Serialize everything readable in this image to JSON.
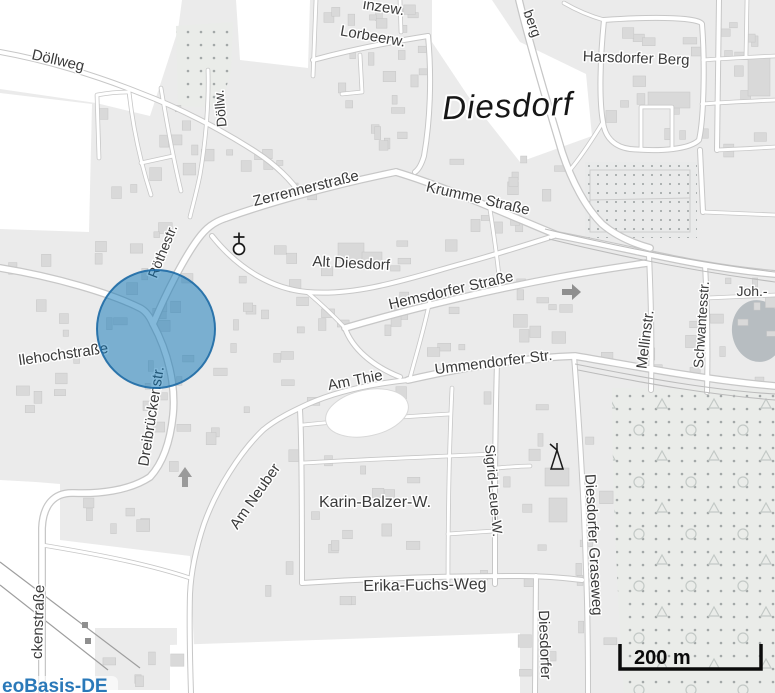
{
  "map": {
    "place_label": "Diesdorf",
    "street_labels": [
      {
        "id": "doellweg",
        "text": "Döllweg",
        "x": 57,
        "y": 65,
        "rot": 13,
        "size": 15
      },
      {
        "id": "doellw",
        "text": "Döllw.",
        "x": 225,
        "y": 108,
        "rot": -95,
        "size": 14
      },
      {
        "id": "inzew",
        "text": "inzew.",
        "x": 383,
        "y": 12,
        "rot": 9,
        "size": 15
      },
      {
        "id": "lorbeerw",
        "text": "Lorbeerw.",
        "x": 372,
        "y": 41,
        "rot": 10,
        "size": 15
      },
      {
        "id": "berg",
        "text": "berg",
        "x": 528,
        "y": 25,
        "rot": 70,
        "size": 14
      },
      {
        "id": "harsdorfer-berg",
        "text": "Harsdorfer Berg",
        "x": 636,
        "y": 63,
        "rot": 2,
        "size": 15
      },
      {
        "id": "diesdorf",
        "text": "Diesdorf",
        "x": 508,
        "y": 117,
        "rot": -2,
        "size": 33,
        "kind": "place"
      },
      {
        "id": "zerrennerstrasse",
        "text": "Zerrennerstraße",
        "x": 307,
        "y": 193,
        "rot": -14,
        "size": 15
      },
      {
        "id": "krumme-strasse",
        "text": "Krumme Straße",
        "x": 477,
        "y": 203,
        "rot": 13,
        "size": 15
      },
      {
        "id": "alt-diesdorf",
        "text": "Alt Diesdorf",
        "x": 351,
        "y": 268,
        "rot": 3,
        "size": 15
      },
      {
        "id": "roethestr",
        "text": "Röthestr.",
        "x": 167,
        "y": 253,
        "rot": -68,
        "size": 14
      },
      {
        "id": "hemsdorfer-strasse",
        "text": "Hemsdorfer Straße",
        "x": 452,
        "y": 295,
        "rot": -13,
        "size": 15
      },
      {
        "id": "joh",
        "text": "Joh.-",
        "x": 752,
        "y": 296,
        "rot": 0,
        "size": 14
      },
      {
        "id": "mellinstr",
        "text": "Mellinstr.",
        "x": 650,
        "y": 340,
        "rot": -83,
        "size": 15
      },
      {
        "id": "schwantesstr",
        "text": "Schwantesstr.",
        "x": 706,
        "y": 325,
        "rot": -86,
        "size": 14
      },
      {
        "id": "llehochstrasse",
        "text": "llehochstraße",
        "x": 64,
        "y": 359,
        "rot": -8,
        "size": 15
      },
      {
        "id": "ummendorfer-str",
        "text": "Ummendorfer Str.",
        "x": 494,
        "y": 367,
        "rot": -7,
        "size": 15
      },
      {
        "id": "am-thie",
        "text": "Am Thie",
        "x": 356,
        "y": 385,
        "rot": -11,
        "size": 15
      },
      {
        "id": "dreibrueckenstr",
        "text": "Dreibrückenstr.",
        "x": 156,
        "y": 417,
        "rot": -81,
        "size": 15
      },
      {
        "id": "am-neuber",
        "text": "Am Neuber",
        "x": 259,
        "y": 499,
        "rot": -55,
        "size": 15
      },
      {
        "id": "karin-balzer-w",
        "text": "Karin-Balzer-W.",
        "x": 375,
        "y": 507,
        "rot": 0,
        "size": 16
      },
      {
        "id": "sigrid-leue-w",
        "text": "Sigrid-Leue-W.",
        "x": 489,
        "y": 491,
        "rot": 85,
        "size": 14
      },
      {
        "id": "erika-fuchs-weg",
        "text": "Erika-Fuchs-Weg",
        "x": 425,
        "y": 590,
        "rot": -1,
        "size": 16
      },
      {
        "id": "diesdorfer-graseweg",
        "text": "Diesdorfer Graseweg",
        "x": 589,
        "y": 545,
        "rot": 87,
        "size": 15
      },
      {
        "id": "diesdorfer-str",
        "text": "Diesdorfer",
        "x": 540,
        "y": 645,
        "rot": 88,
        "size": 15
      },
      {
        "id": "ckenstrasse",
        "text": "ckenstraße",
        "x": 43,
        "y": 622,
        "rot": -88,
        "size": 15
      }
    ],
    "highlight_circle": {
      "cx": 156,
      "cy": 329,
      "r": 59,
      "fill": "#0a73b6",
      "fill_opacity": 0.5,
      "stroke": "#1d6aa5",
      "stroke_opacity": 0.9
    },
    "colors": {
      "residential": "#ebebeb",
      "building": "#d9d9d9",
      "road_casing": "#c7c7c7",
      "orchard_dot": "#a3a8a8",
      "pond_gray": "#b7bdc1"
    }
  },
  "scale_bar": {
    "label": "200 m"
  },
  "attribution": {
    "text": "eoBasis-DE"
  }
}
